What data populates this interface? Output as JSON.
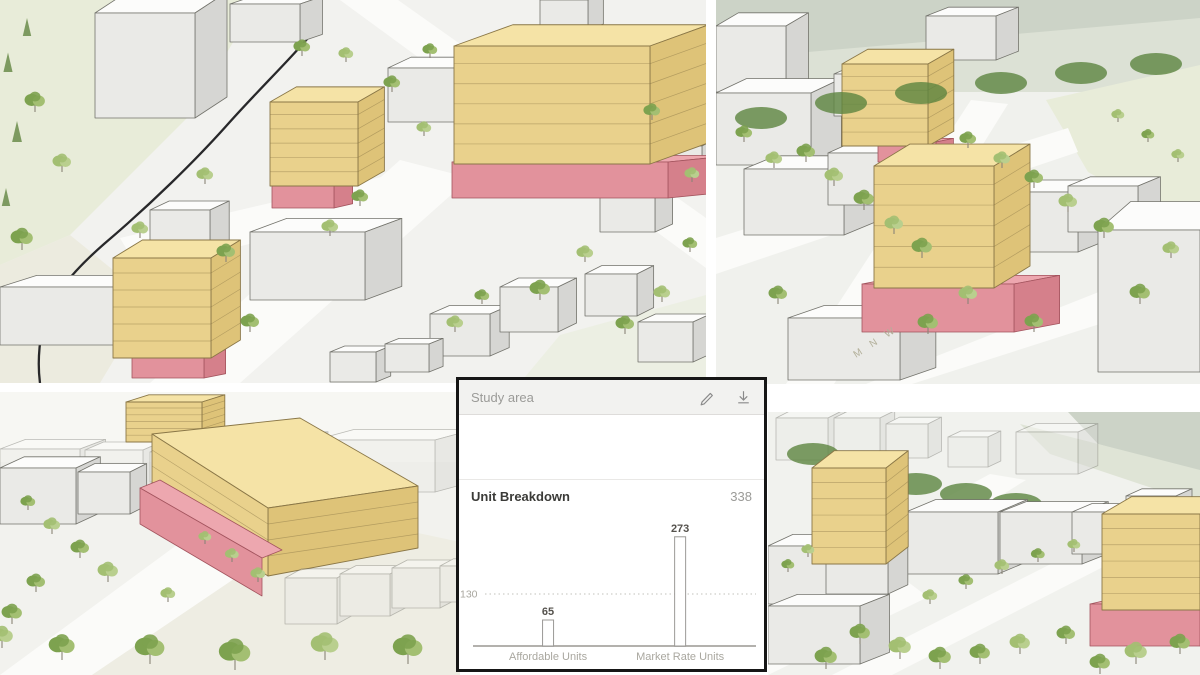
{
  "panel": {
    "title": "Study area",
    "section_title": "Unit Breakdown",
    "total": "338",
    "icons": [
      {
        "name": "edit-pencil-icon"
      },
      {
        "name": "download-icon"
      }
    ]
  },
  "chart_data": {
    "type": "bar",
    "title": "Unit Breakdown",
    "categories": [
      "Affordable Units",
      "Market Rate Units"
    ],
    "values": [
      65,
      273
    ],
    "total": 338,
    "gridline_value": 130,
    "ylim": [
      0,
      300
    ],
    "grid": "dotted line at 130 only",
    "legend": "none",
    "bar_fill": "#ffffff",
    "bar_outline": "#9b9996"
  },
  "scenes": {
    "top_left": {
      "name": "aerial-overview-render"
    },
    "top_right": {
      "name": "closeup-proposal-render",
      "street_label": "M N W"
    },
    "bottom_left": {
      "name": "street-level-render"
    },
    "bottom_right": {
      "name": "corridor-render"
    }
  },
  "colors": {
    "proposed_yellow_top": "#f5e3a6",
    "proposed_yellow_front": "#e9d18c",
    "proposed_yellow_side": "#dec378",
    "proposed_outline": "#8a7747",
    "podium_pink_top": "#eda7af",
    "podium_pink_front": "#e2929c",
    "podium_pink_side": "#d5808b",
    "podium_outline": "#a3545e",
    "context_building_top": "#fcfcfb",
    "context_building_front": "#eaeae7",
    "context_building_side": "#d6d6d3",
    "context_outline": "#73736c",
    "tree_green": "#7da24f",
    "tree_green_light": "#a3bf72",
    "tree_green_dark": "#5d8540",
    "ground": "#f2f2ef",
    "ground_green": "#e8ecd9",
    "road": "#fbfbf9",
    "water": "#ccd3c7",
    "panel_border": "#161616",
    "panel_header_bg": "#f2f2f0",
    "text_gray": "#9b9b98",
    "text_dark": "#3b3b38",
    "axis_gray": "#a9a79f"
  }
}
